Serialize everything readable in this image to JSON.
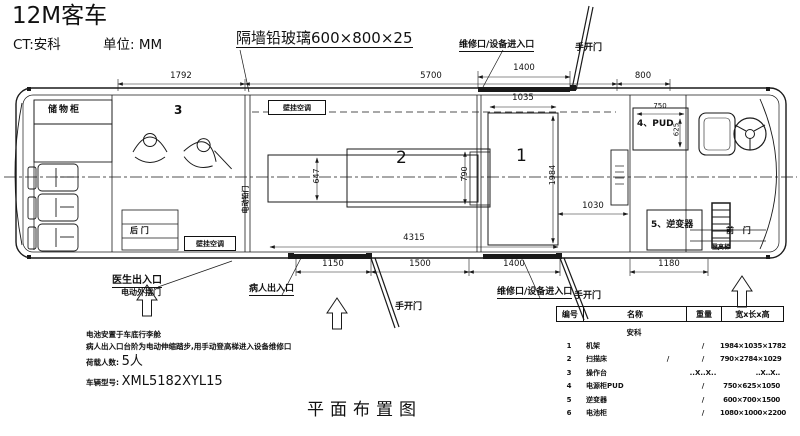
{
  "header": {
    "title": "12M客车",
    "subtitle_ct": "CT:安科",
    "unit": "单位: MM",
    "glass_callout": "隔墙铅玻璃600×800×25"
  },
  "top_labels": {
    "maintenance_port": "维修口/设备进入口",
    "manual_door": "手开门",
    "dim_1792": "1792",
    "dim_5700": "5700",
    "dim_1400": "1400",
    "dim_800": "800"
  },
  "cabin": {
    "storage_cabinet": "储物柜",
    "room3_no": "3",
    "room2_no": "2",
    "room1_no": "1",
    "rear_door": "后 门",
    "wall_ac_rear": "壁挂空调",
    "wall_ac_mid": "壁挂空调",
    "electric_lead_door": "电动铅门",
    "pud_box": "4、PUD",
    "inverter_box": "5、逆变器",
    "front_door": "前 门",
    "ladder": "登高梯",
    "dim_647": "647",
    "dim_790": "790",
    "dim_4315": "4315",
    "dim_1035": "1035",
    "dim_1984": "1984",
    "dim_1030": "1030",
    "dim_750": "750",
    "dim_625": "625"
  },
  "bottom_labels": {
    "doctor_exit": "医生出入口",
    "electric_outswing_door": "电动外摆门",
    "patient_entrance": "病人出入口",
    "manual_door_1": "手开门",
    "maintenance_port": "维修口/设备进入口",
    "manual_door_2": "手开门",
    "dim_1150": "1150",
    "dim_1500": "1500",
    "dim_1400": "1400",
    "dim_1180": "1180"
  },
  "notes": {
    "line1": "电池安置于车底行李舱",
    "line2": "病人出入口台阶为电动伸缩踏步,用手动登高梯进入设备维修口",
    "line3_label": "荷载人数:",
    "line3_value": "5人",
    "line4_label": "车辆型号:",
    "line4_value": "XML5182XYL15"
  },
  "caption": "平面布置图",
  "table": {
    "headers": [
      "编号",
      "名称",
      "重量",
      "宽x长x高"
    ],
    "brand": "安科",
    "rows": [
      {
        "no": "1",
        "name": "机架",
        "mid": "",
        "weight": "/",
        "size": "1984×1035×1782"
      },
      {
        "no": "2",
        "name": "扫描床",
        "mid": "/",
        "weight": "/",
        "size": "790×2784×1029"
      },
      {
        "no": "3",
        "name": "操作台",
        "mid": "",
        "weight": "..X..X..",
        "size": "..X..X.."
      },
      {
        "no": "4",
        "name": "电源柜PUD",
        "mid": "",
        "weight": "/",
        "size": "750×625×1050"
      },
      {
        "no": "5",
        "name": "逆变器",
        "mid": "",
        "weight": "/",
        "size": "600×700×1500"
      },
      {
        "no": "6",
        "name": "电池柜",
        "mid": "",
        "weight": "/",
        "size": "1080×1000×2200"
      }
    ]
  },
  "colors": {
    "line": "#1a1a1a",
    "background": "#ffffff"
  }
}
